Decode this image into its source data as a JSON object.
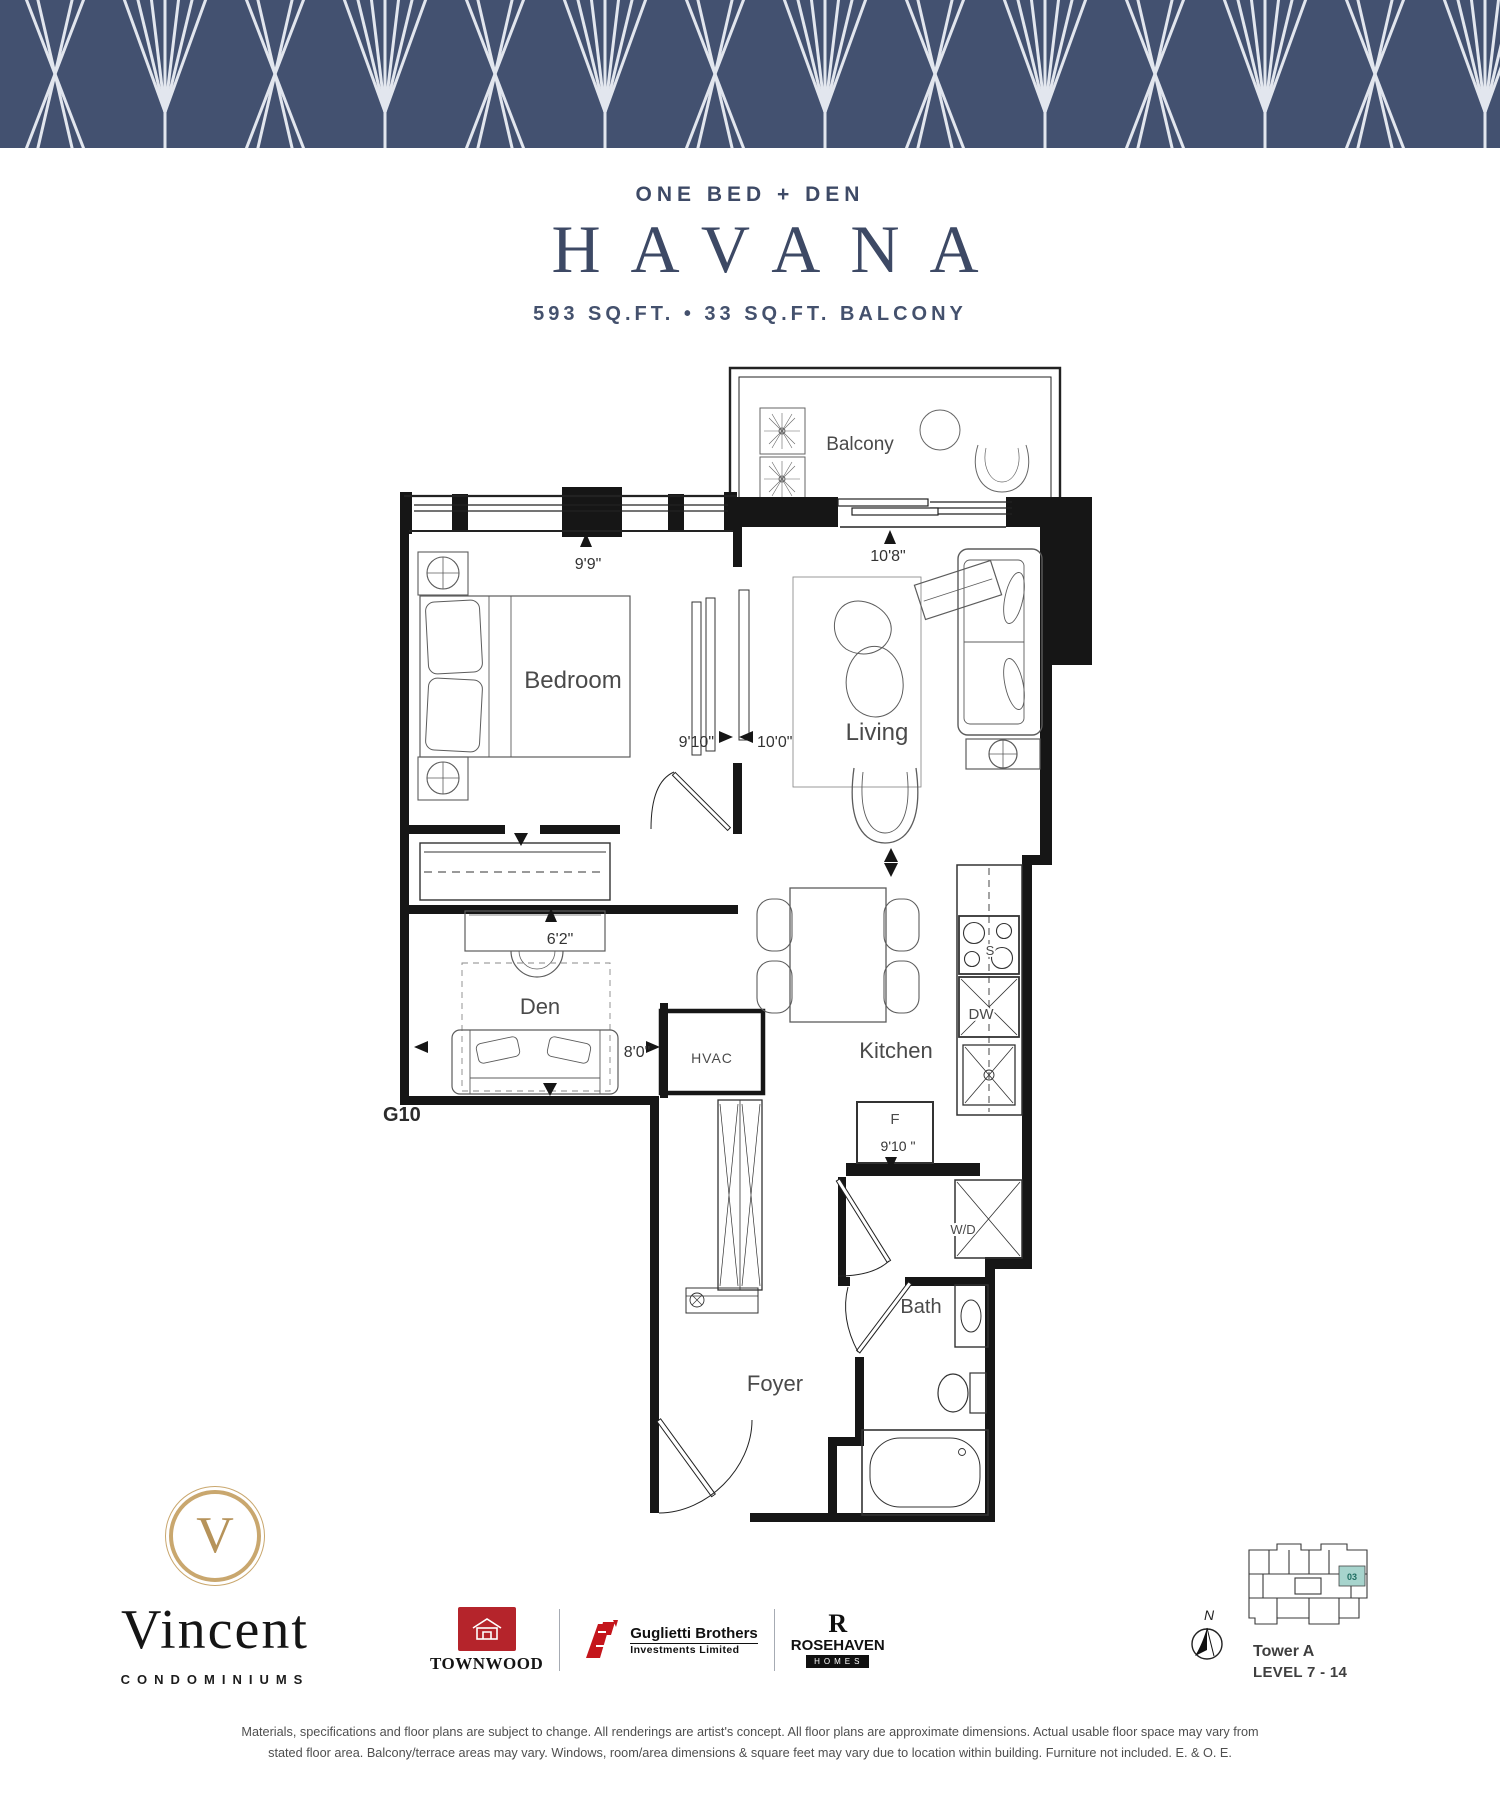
{
  "header": {
    "band_color": "#435170",
    "pattern_line_color": "#e2e6ee"
  },
  "title": {
    "type_label": "ONE BED + DEN",
    "name": "HAVANA",
    "area_label": "593 SQ.FT. • 33 SQ.FT. BALCONY"
  },
  "plan": {
    "unit_code": "G10",
    "labels": {
      "balcony": "Balcony",
      "bedroom": "Bedroom",
      "living": "Living",
      "den": "Den",
      "kitchen": "Kitchen",
      "foyer": "Foyer",
      "bath": "Bath",
      "hvac": "HVAC",
      "washer_dryer": "W/D",
      "fridge": "F",
      "stove": "S",
      "dishwasher": "DW"
    },
    "dimensions": {
      "bedroom_window": "9'9\"",
      "living_window": "10'8\"",
      "bedroom_depth": "9'10\"",
      "living_depth": "10'0\"",
      "den_desk_wall": "6'2\"",
      "den_width": "8'0\"",
      "kitchen_run": "9'10 \""
    }
  },
  "footer": {
    "brand": {
      "monogram": "V",
      "name": "Vincent",
      "subtitle": "CONDOMINIUMS"
    },
    "builders": {
      "townwood": "TOWNWOOD",
      "guglietti_line1": "Guglietti Brothers",
      "guglietti_line2": "Investments Limited",
      "rosehaven_monogram": "R",
      "rosehaven": "ROSEHAVEN",
      "rosehaven_sub": "HOMES"
    },
    "compass": "N",
    "keyplan": {
      "unit": "03",
      "tower": "Tower A",
      "level": "LEVEL 7 - 14"
    },
    "disclaimer": "Materials, specifications and floor plans are subject to change. All renderings are artist's concept. All floor plans are approximate dimensions. Actual usable floor space may vary from stated floor area. Balcony/terrace areas may vary. Windows, room/area dimensions & square feet may vary due to location within building. Furniture not included. E. & O. E."
  }
}
